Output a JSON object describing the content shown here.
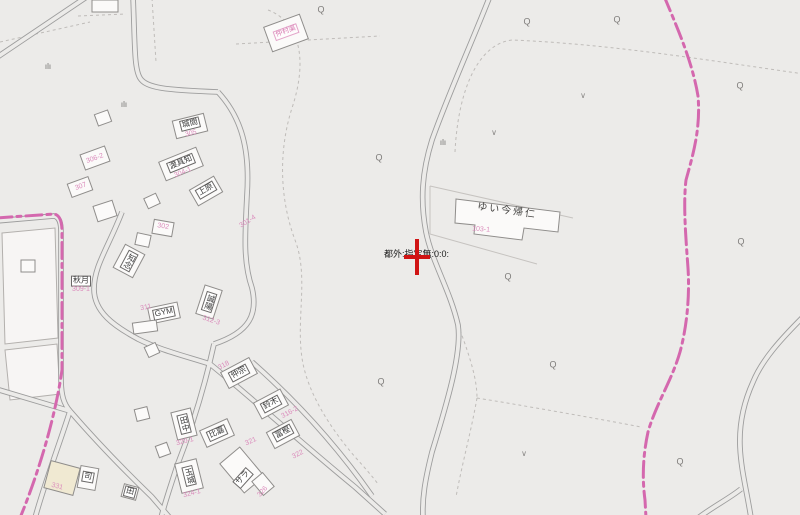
{
  "map": {
    "background": "#ECEBE9",
    "colors": {
      "road_line": "#9D9D9D",
      "parcel_line": "#BFBCB9",
      "pink_boundary": "#D468AE",
      "pink_text": "#DB8CBC",
      "label_text": "#3A3A3A",
      "building_fill": "#FBFAF9",
      "building_stroke": "#8F8D8B",
      "beige_building_fill": "#F0E9D2",
      "marker_red": "#D01414",
      "symbol_gray": "#7F7D7B"
    },
    "marker": {
      "text": "都外:指定無:0:0:"
    },
    "labels": [
      {
        "text": "ゆい今帰仁",
        "x": 507,
        "y": 211,
        "rot": 8,
        "cls": "facility",
        "name": "facility-label"
      },
      {
        "text": "103-1",
        "x": 481,
        "y": 230,
        "rot": 4,
        "cls": "lot",
        "name": "lot-number-label"
      },
      {
        "text": "仲村渠",
        "x": 286,
        "y": 32,
        "rot": -20,
        "cls": "pinkbox",
        "name": "pink-name-label"
      },
      {
        "text": "城間",
        "x": 190,
        "y": 124,
        "rot": -14,
        "cls": "box",
        "name": "building-label"
      },
      {
        "text": "305",
        "x": 191,
        "y": 134,
        "rot": -14,
        "cls": "lot",
        "name": "lot-number-label"
      },
      {
        "text": "301-4",
        "x": 248,
        "y": 222,
        "rot": -32,
        "cls": "lot",
        "name": "lot-number-label"
      },
      {
        "text": "306-2",
        "x": 95,
        "y": 159,
        "rot": -20,
        "cls": "lot",
        "name": "lot-number-label"
      },
      {
        "text": "307",
        "x": 81,
        "y": 187,
        "rot": -20,
        "cls": "lot",
        "name": "lot-number-label"
      },
      {
        "text": "渡具知",
        "x": 181,
        "y": 163,
        "rot": -22,
        "cls": "box",
        "name": "building-label"
      },
      {
        "text": "304-1",
        "x": 183,
        "y": 173,
        "rot": -22,
        "cls": "lot",
        "name": "lot-number-label"
      },
      {
        "text": "上原",
        "x": 206,
        "y": 190,
        "rot": -30,
        "cls": "box",
        "name": "building-label"
      },
      {
        "text": "302",
        "x": 163,
        "y": 227,
        "rot": 10,
        "cls": "lot",
        "name": "lot-number-label"
      },
      {
        "text": "知念",
        "x": 129,
        "y": 261,
        "rot": 28,
        "cls": "box vert",
        "name": "building-label"
      },
      {
        "text": "秋月",
        "x": 81,
        "y": 281,
        "rot": 0,
        "cls": "box",
        "name": "building-label"
      },
      {
        "text": "309-1",
        "x": 81,
        "y": 290,
        "rot": 0,
        "cls": "lot",
        "name": "lot-number-label"
      },
      {
        "text": "GYM",
        "x": 164,
        "y": 313,
        "rot": -12,
        "cls": "box",
        "name": "building-label"
      },
      {
        "text": "311",
        "x": 146,
        "y": 308,
        "rot": -12,
        "cls": "lot",
        "name": "lot-number-label"
      },
      {
        "text": "誠陽",
        "x": 209,
        "y": 302,
        "rot": 18,
        "cls": "box vert",
        "name": "building-label"
      },
      {
        "text": "312-3",
        "x": 211,
        "y": 321,
        "rot": 18,
        "cls": "lot",
        "name": "lot-number-label"
      },
      {
        "text": "仲宗",
        "x": 239,
        "y": 373,
        "rot": -28,
        "cls": "box",
        "name": "building-label"
      },
      {
        "text": "318",
        "x": 224,
        "y": 366,
        "rot": -28,
        "cls": "lot",
        "name": "lot-number-label"
      },
      {
        "text": "田中",
        "x": 184,
        "y": 424,
        "rot": -14,
        "cls": "box vert",
        "name": "building-label"
      },
      {
        "text": "320-1",
        "x": 185,
        "y": 442,
        "rot": -14,
        "cls": "lot",
        "name": "lot-number-label"
      },
      {
        "text": "比嘉",
        "x": 217,
        "y": 433,
        "rot": -24,
        "cls": "box",
        "name": "building-label"
      },
      {
        "text": "321",
        "x": 251,
        "y": 442,
        "rot": -24,
        "cls": "lot",
        "name": "lot-number-label"
      },
      {
        "text": "鈴木",
        "x": 271,
        "y": 404,
        "rot": -28,
        "cls": "box",
        "name": "building-label"
      },
      {
        "text": "316-2",
        "x": 290,
        "y": 413,
        "rot": -28,
        "cls": "lot",
        "name": "lot-number-label"
      },
      {
        "text": "冨樫",
        "x": 283,
        "y": 433,
        "rot": -28,
        "cls": "box",
        "name": "building-label"
      },
      {
        "text": "322",
        "x": 298,
        "y": 455,
        "rot": -28,
        "cls": "lot",
        "name": "lot-number-label"
      },
      {
        "text": "玉城",
        "x": 189,
        "y": 476,
        "rot": -14,
        "cls": "box vert",
        "name": "building-label"
      },
      {
        "text": "324-1",
        "x": 192,
        "y": 494,
        "rot": -14,
        "cls": "lot",
        "name": "lot-number-label"
      },
      {
        "text": "サラ",
        "x": 243,
        "y": 478,
        "rot": -48,
        "cls": "box",
        "name": "building-label"
      },
      {
        "text": "326",
        "x": 263,
        "y": 492,
        "rot": -48,
        "cls": "lot",
        "name": "lot-number-label"
      },
      {
        "text": "司",
        "x": 88,
        "y": 477,
        "rot": 10,
        "cls": "box",
        "name": "building-label"
      },
      {
        "text": "331",
        "x": 57,
        "y": 487,
        "rot": 15,
        "cls": "lot",
        "name": "lot-number-label"
      },
      {
        "text": "田",
        "x": 130,
        "y": 492,
        "rot": 15,
        "cls": "box",
        "name": "building-label"
      }
    ],
    "buildings": [
      {
        "x": 105,
        "y": 6,
        "w": 26,
        "h": 12,
        "r": 0
      },
      {
        "x": 286,
        "y": 33,
        "w": 38,
        "h": 26,
        "r": -20
      },
      {
        "x": 190,
        "y": 126,
        "w": 32,
        "h": 18,
        "r": -14
      },
      {
        "x": 103,
        "y": 118,
        "w": 14,
        "h": 12,
        "r": -20
      },
      {
        "x": 95,
        "y": 158,
        "w": 26,
        "h": 16,
        "r": -20
      },
      {
        "x": 80,
        "y": 187,
        "w": 22,
        "h": 14,
        "r": -20
      },
      {
        "x": 181,
        "y": 164,
        "w": 40,
        "h": 20,
        "r": -22
      },
      {
        "x": 206,
        "y": 191,
        "w": 28,
        "h": 18,
        "r": -30
      },
      {
        "x": 152,
        "y": 201,
        "w": 13,
        "h": 11,
        "r": -25
      },
      {
        "x": 105,
        "y": 211,
        "w": 20,
        "h": 16,
        "r": -18
      },
      {
        "x": 163,
        "y": 228,
        "w": 20,
        "h": 14,
        "r": 10
      },
      {
        "x": 143,
        "y": 240,
        "w": 14,
        "h": 12,
        "r": 12
      },
      {
        "x": 129,
        "y": 261,
        "w": 22,
        "h": 26,
        "r": 28
      },
      {
        "x": 28,
        "y": 266,
        "w": 14,
        "h": 12,
        "r": 0
      },
      {
        "x": 164,
        "y": 313,
        "w": 30,
        "h": 16,
        "r": -12
      },
      {
        "x": 209,
        "y": 302,
        "w": 18,
        "h": 30,
        "r": 18
      },
      {
        "x": 145,
        "y": 327,
        "w": 24,
        "h": 11,
        "r": -8
      },
      {
        "x": 152,
        "y": 350,
        "w": 12,
        "h": 11,
        "r": -25
      },
      {
        "x": 239,
        "y": 373,
        "w": 32,
        "h": 18,
        "r": -28
      },
      {
        "x": 184,
        "y": 424,
        "w": 20,
        "h": 28,
        "r": -14
      },
      {
        "x": 142,
        "y": 414,
        "w": 13,
        "h": 12,
        "r": -14
      },
      {
        "x": 217,
        "y": 433,
        "w": 30,
        "h": 18,
        "r": -24
      },
      {
        "x": 271,
        "y": 404,
        "w": 30,
        "h": 18,
        "r": -28
      },
      {
        "x": 283,
        "y": 434,
        "w": 28,
        "h": 18,
        "r": -28
      },
      {
        "x": 189,
        "y": 476,
        "w": 22,
        "h": 30,
        "r": -14
      },
      {
        "x": 242,
        "y": 470,
        "w": 26,
        "h": 38,
        "r": -40
      },
      {
        "x": 263,
        "y": 484,
        "w": 14,
        "h": 18,
        "r": -40
      },
      {
        "x": 62,
        "y": 478,
        "w": 30,
        "h": 28,
        "r": 15,
        "beige": true
      },
      {
        "x": 88,
        "y": 478,
        "w": 18,
        "h": 22,
        "r": 10
      },
      {
        "x": 130,
        "y": 492,
        "w": 15,
        "h": 13,
        "r": 15
      },
      {
        "x": 163,
        "y": 450,
        "w": 12,
        "h": 12,
        "r": -20
      }
    ],
    "symbols": {
      "q_marks": [
        {
          "x": 321,
          "y": 10
        },
        {
          "x": 527,
          "y": 22
        },
        {
          "x": 617,
          "y": 20
        },
        {
          "x": 740,
          "y": 86
        },
        {
          "x": 379,
          "y": 158
        },
        {
          "x": 741,
          "y": 242
        },
        {
          "x": 508,
          "y": 277
        },
        {
          "x": 553,
          "y": 365
        },
        {
          "x": 381,
          "y": 382
        },
        {
          "x": 680,
          "y": 462
        }
      ],
      "v_marks": [
        {
          "x": 583,
          "y": 96
        },
        {
          "x": 494,
          "y": 133
        },
        {
          "x": 524,
          "y": 454
        }
      ],
      "grass_marks": [
        {
          "x": 48,
          "y": 67
        },
        {
          "x": 124,
          "y": 105
        },
        {
          "x": 443,
          "y": 143
        }
      ],
      "q_glyph": "Q",
      "v_glyph": "∨",
      "grass_glyph": "ılı"
    }
  }
}
